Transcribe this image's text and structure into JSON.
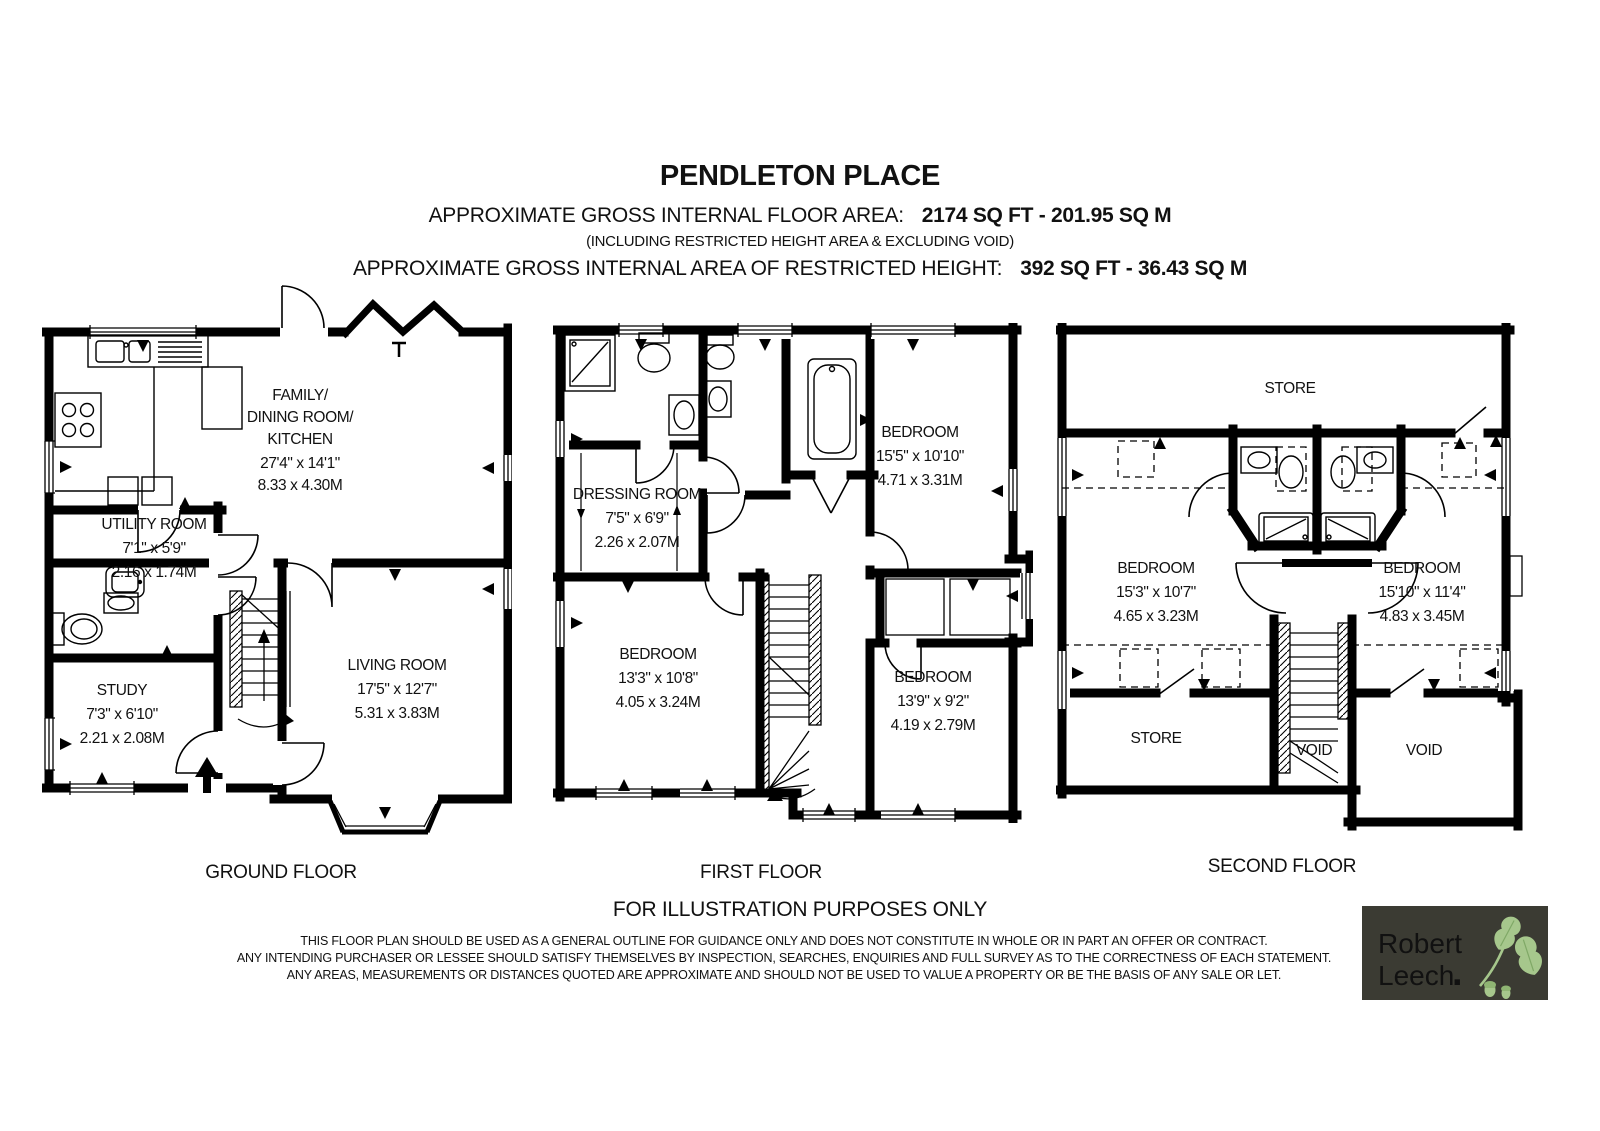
{
  "header": {
    "title": "PENDLETON PLACE",
    "area_label": "APPROXIMATE GROSS INTERNAL FLOOR AREA:",
    "area_value": "2174 SQ FT - 201.95 SQ M",
    "area_note": "(INCLUDING RESTRICTED HEIGHT AREA & EXCLUDING VOID)",
    "restricted_label": "APPROXIMATE GROSS INTERNAL AREA OF RESTRICTED HEIGHT:",
    "restricted_value": "392 SQ FT - 36.43 SQ M"
  },
  "floors": {
    "ground": {
      "label": "GROUND FLOOR",
      "rooms": {
        "family_dining_kitchen": {
          "lines": [
            "FAMILY/",
            "DINING ROOM/",
            "KITCHEN",
            "27'4\" x 14'1\"",
            "8.33 x 4.30M"
          ]
        },
        "utility": {
          "lines": [
            "UTILITY ROOM",
            "7'1\" x 5'9\"",
            "2.16 x 1.74M"
          ]
        },
        "study": {
          "lines": [
            "STUDY",
            "7'3\" x 6'10\"",
            "2.21 x 2.08M"
          ]
        },
        "living": {
          "lines": [
            "LIVING ROOM",
            "17'5\" x 12'7\"",
            "5.31 x 3.83M"
          ]
        }
      }
    },
    "first": {
      "label": "FIRST FLOOR",
      "rooms": {
        "dressing": {
          "lines": [
            "DRESSING ROOM",
            "7'5\" x 6'9\"",
            "2.26 x 2.07M"
          ]
        },
        "bedroom_top_right": {
          "lines": [
            "BEDROOM",
            "15'5\" x 10'10\"",
            "4.71 x 3.31M"
          ]
        },
        "bedroom_bottom_left": {
          "lines": [
            "BEDROOM",
            "13'3\" x 10'8\"",
            "4.05 x 3.24M"
          ]
        },
        "bedroom_bottom_right": {
          "lines": [
            "BEDROOM",
            "13'9\" x 9'2\"",
            "4.19 x 2.79M"
          ]
        }
      }
    },
    "second": {
      "label": "SECOND FLOOR",
      "rooms": {
        "store_top": {
          "lines": [
            "STORE"
          ]
        },
        "bedroom_left": {
          "lines": [
            "BEDROOM",
            "15'3\" x 10'7\"",
            "4.65 x 3.23M"
          ]
        },
        "bedroom_right": {
          "lines": [
            "BEDROOM",
            "15'10\" x 11'4\"",
            "4.83 x 3.45M"
          ]
        },
        "store_bottom": {
          "lines": [
            "STORE"
          ]
        },
        "void_center": {
          "lines": [
            "VOID"
          ]
        },
        "void_right": {
          "lines": [
            "VOID"
          ]
        }
      }
    }
  },
  "footer": {
    "illustration_note": "FOR ILLUSTRATION PURPOSES ONLY",
    "disclaimer": [
      "THIS FLOOR PLAN SHOULD BE USED AS A GENERAL OUTLINE FOR GUIDANCE ONLY AND DOES NOT CONSTITUTE IN WHOLE OR IN PART AN OFFER OR CONTRACT.",
      "ANY INTENDING PURCHASER OR LESSEE SHOULD SATISFY THEMSELVES BY INSPECTION, SEARCHES, ENQUIRIES AND FULL SURVEY AS TO THE CORRECTNESS OF EACH STATEMENT.",
      "ANY AREAS, MEASUREMENTS OR DISTANCES QUOTED ARE APPROXIMATE AND SHOULD NOT BE USED TO VALUE A PROPERTY OR BE THE BASIS OF ANY SALE OR LET."
    ]
  },
  "logo": {
    "name_line1": "Robert",
    "name_line2": "Leech",
    "dot": ".",
    "colors": {
      "background": "#3B3B33",
      "text": "#F2EFE3",
      "dot": "#C52B50",
      "leaf": "#A6C78C",
      "leaf_dark": "#7FA866"
    }
  }
}
